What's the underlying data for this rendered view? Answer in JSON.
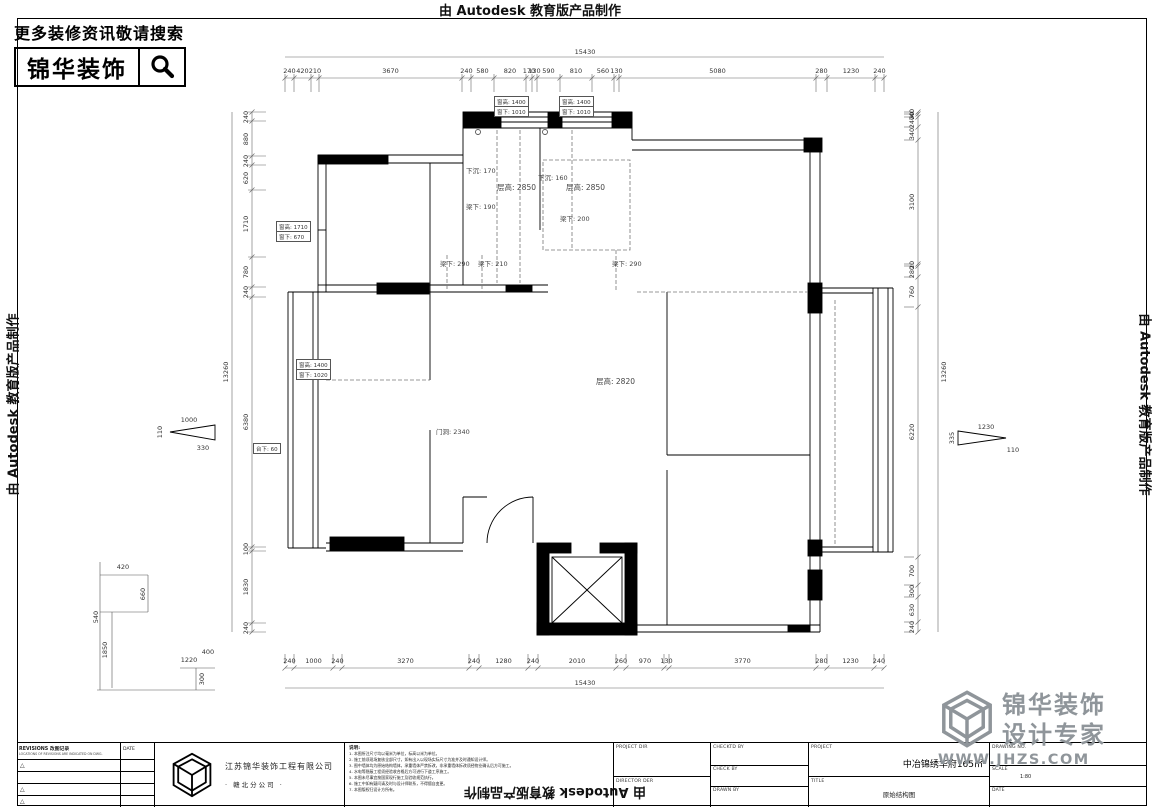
{
  "edge_note": "由 Autodesk 教育版产品制作",
  "banner": {
    "tagline": "更多装修资讯敬请搜索",
    "brand": "锦华装饰"
  },
  "dims": {
    "top_total": "15430",
    "bottom_total": "15430",
    "left_total": "13260",
    "right_total": "13260",
    "top": [
      "240",
      "420",
      "210",
      "3670",
      "240",
      "580",
      "820",
      "170",
      "130",
      "590",
      "810",
      "560",
      "130",
      "5080",
      "280",
      "1230",
      "240"
    ],
    "bottom": [
      "240",
      "1000",
      "240",
      "3270",
      "240",
      "1280",
      "240",
      "2010",
      "260",
      "970",
      "130",
      "3770",
      "280",
      "1230",
      "240"
    ],
    "left": [
      "240",
      "880",
      "240",
      "620",
      "1710",
      "780",
      "240",
      "6380",
      "100",
      "1830",
      "240"
    ],
    "right": [
      "40",
      "70",
      "240",
      "340",
      "3100",
      "20",
      "280",
      "760",
      "6220",
      "700",
      "300",
      "630",
      "240"
    ],
    "left_pointer": {
      "top": "1000",
      "side": "110",
      "bottom": "330"
    },
    "right_pointer": {
      "top": "1230",
      "side": "335",
      "bottom": "110"
    },
    "detail": [
      "420",
      "660",
      "540",
      "1850",
      "1220",
      "400",
      "300"
    ]
  },
  "boxes": {
    "win1": [
      "窗高: 1400",
      "窗下: 1010"
    ],
    "win2": [
      "窗高: 1400",
      "窗下: 1010"
    ],
    "win3": [
      "窗高: 1710",
      "窗下: 670"
    ],
    "win4": [
      "窗高: 1400",
      "窗下: 1020"
    ],
    "counter": [
      "台下: 60"
    ]
  },
  "plan_notes": {
    "sink1": "下沉: 170",
    "height1": "层高: 2850",
    "beam1": "梁下: 190",
    "sink2": "下沉: 160",
    "height2": "层高: 2850",
    "beam2": "梁下: 200",
    "beam3": "梁下: 290",
    "beam4": "梁下: 210",
    "beam5": "梁下: 290",
    "height_main": "层高: 2820",
    "door": "门洞: 2340"
  },
  "titleblock": {
    "revisions_title": "REVISIONS 改图记录",
    "revisions_sub": "LOCATIONS OF REVISIONS ARE INDICATED ON DWG.",
    "date_col": "DATE",
    "company_line1": "江苏锦华装饰工程有限公司",
    "company_line2": "·  赣北分公司  ·",
    "notes_title": "说明:",
    "notes": [
      "1. 本图所注尺寸均以毫米为单位，标高以米为单位。",
      "2. 施工前须现场复核全部尺寸，如有出入以现场实际尺寸为准并及时通知设计师。",
      "3. 图中墙体均为原始结构墙体，承重墙体严禁拆改，非承重墙体拆改须经物业确认后方可施工。",
      "4. 水电等隐蔽工程须经验收合格后方可进行下道工序施工。",
      "5. 本图未尽事宜按国家现行施工及验收规范执行。",
      "6. 施工中如有疑问请及时与设计师联系，不得擅自变更。",
      "7. 本图版权归设计方所有。"
    ],
    "fields": {
      "project_dir": "PROJECT DIR",
      "director": "DIRECTOR DER",
      "checked": "CHECKTD BY",
      "check": "CHECK BY",
      "drawn": "DRAWN BY",
      "project_label": "PROJECT",
      "project_value": "中冶锦绣华府165㎡",
      "title_label": "TITLE",
      "title_value": "原始结构图",
      "drawing_no": "DRAWING NO.",
      "scale_label": "SCALE",
      "scale_value": "1:80",
      "date_label": "DATE"
    }
  },
  "watermark": {
    "brand": "锦华装饰",
    "tag": "设计专家",
    "url": "WWW.JHZS.COM"
  }
}
